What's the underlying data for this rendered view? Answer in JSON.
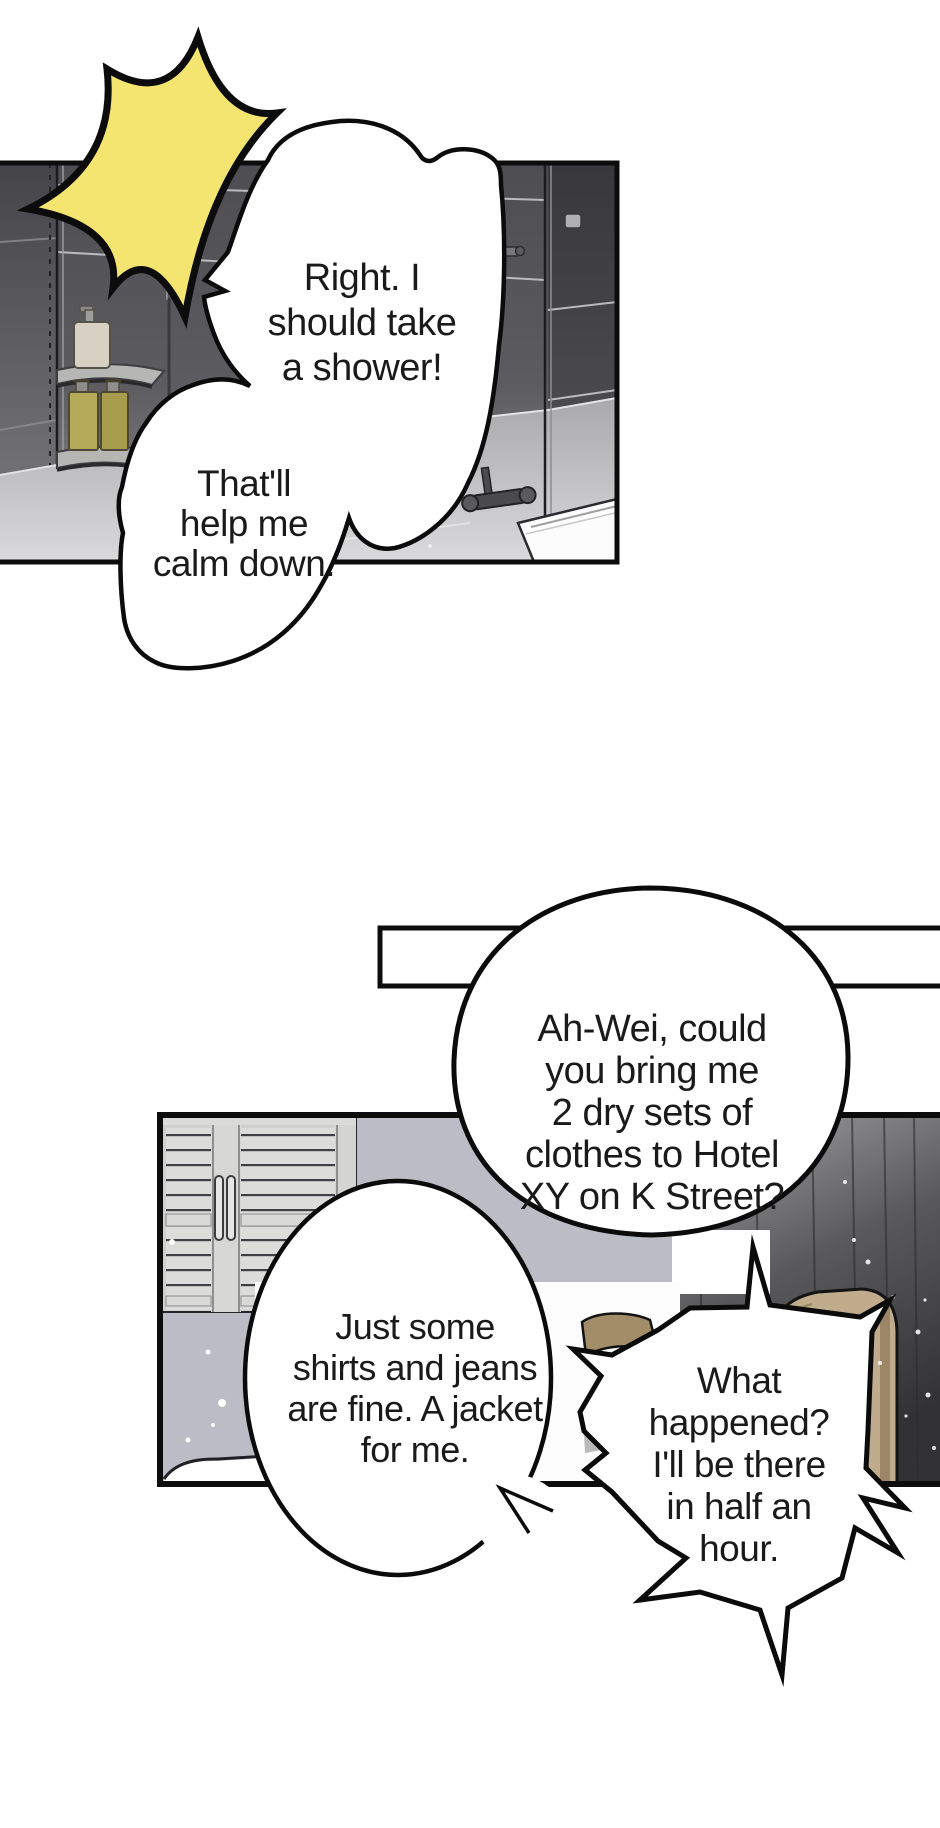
{
  "page": {
    "type": "webtoon-comic-page",
    "width": 940,
    "height": 1828,
    "background": "#ffffff"
  },
  "colors": {
    "ink": "#0c0c0c",
    "bubble_fill": "#ffffff",
    "flash_yellow": "#f3e56f",
    "tile_dark": "#515156",
    "floor_gray": "#c9c9cb",
    "closet_gray": "#dcdcda",
    "wall_lavender": "#bcbcc6",
    "curtain_dark": "#38383a",
    "headboard_tan": "#c0ab8c",
    "bottle_olive": "#b2a858",
    "bottle_cream": "#d8d1c3"
  },
  "panels": [
    {
      "name": "bathroom-panel",
      "scene": "tiled shower room with corner shelves, bottles, mixer tap and tub",
      "effects": [
        "impact-flash"
      ],
      "bubbles": [
        {
          "id": "shower",
          "lines": [
            "Right. I",
            "should take",
            "a shower!"
          ]
        },
        {
          "id": "calm",
          "lines": [
            "That'll",
            "help me",
            "calm down."
          ]
        }
      ]
    },
    {
      "name": "bedroom-panel",
      "scene": "bedroom with louvered closet, lavender wall, dark curtain, tan headboard and bed",
      "bubbles": [
        {
          "id": "request",
          "lines": [
            "Ah-Wei, could",
            "you bring me",
            "2 dry sets of",
            "clothes to Hotel",
            "XY on K Street?"
          ]
        },
        {
          "id": "clothes",
          "lines": [
            "Just some",
            "shirts and jeans",
            "are fine. A jacket",
            "for me."
          ]
        },
        {
          "id": "reply",
          "lines": [
            "What",
            "happened?",
            "I'll be there",
            "in half an",
            "hour."
          ]
        }
      ]
    }
  ]
}
